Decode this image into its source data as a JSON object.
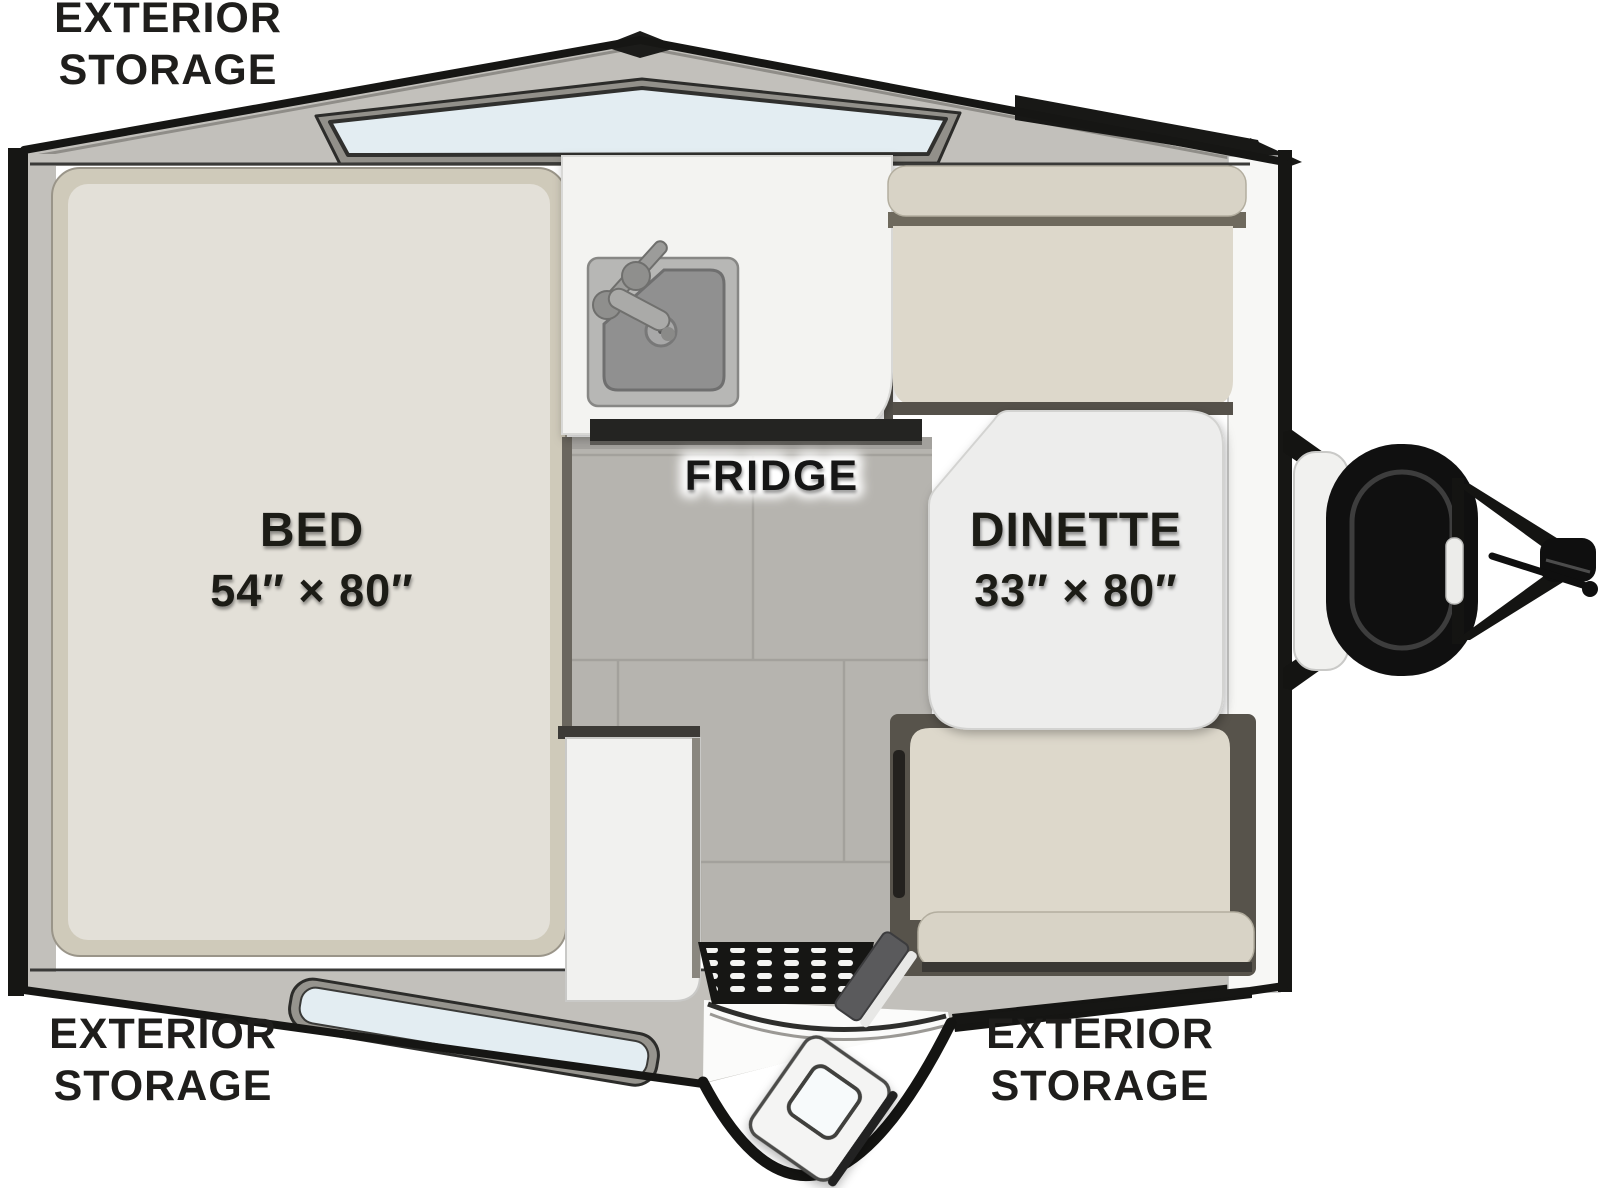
{
  "plan": {
    "type": "camper-floor-plan",
    "labels": {
      "storage_top_left": {
        "line1": "EXTERIOR",
        "line2": "STORAGE"
      },
      "storage_bottom_left": {
        "line1": "EXTERIOR",
        "line2": "STORAGE"
      },
      "storage_bottom_right": {
        "line1": "EXTERIOR",
        "line2": "STORAGE"
      },
      "bed": {
        "name": "BED",
        "dimensions": "54″ × 80″"
      },
      "dinette": {
        "name": "DINETTE",
        "dimensions": "33″ × 80″"
      },
      "fridge": "FRIDGE"
    },
    "colors": {
      "outline": "#161616",
      "wall_band": "#c2c0bb",
      "window_glass": "#e3edf2",
      "window_frame": "#92908a",
      "cushion": "#ddd8cb",
      "cushion_edge": "#d3cec1",
      "bed_inner": "#e3e0d8",
      "bed_edge": "#cfcaba",
      "floor_tile": "#b6b4af",
      "floor_grout": "#a3a19c",
      "counter": "#f3f3f1",
      "fridge_strip": "#242424",
      "hitch_black": "#121212",
      "text": "#1f1e1c"
    }
  }
}
